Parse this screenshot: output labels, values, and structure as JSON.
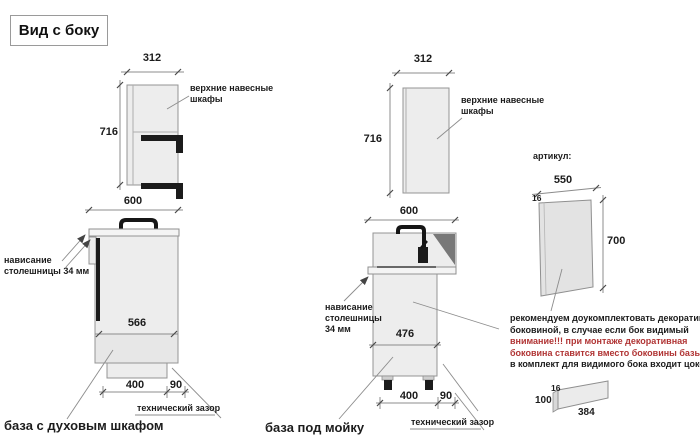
{
  "title": "Вид с боку",
  "colors": {
    "warning_red": "#b03434",
    "cabinet_fill": "#ededed",
    "line_gray": "#8c8c8c",
    "black": "#1b1b1b"
  },
  "wall_cabinet_left": {
    "width_dim": "312",
    "height_dim": "716",
    "label_line1": "верхние навесные",
    "label_line2": "шкафы"
  },
  "base_oven": {
    "width_dim": "600",
    "overhang_line1": "нависание",
    "overhang_line2": "столешницы 34 мм",
    "depth_dim": "566",
    "plinth_dim": "400",
    "gap_dim": "90",
    "gap_label": "технический зазор",
    "caption": "база с духовым шкафом"
  },
  "wall_cabinet_mid": {
    "width_dim": "312",
    "height_dim": "716",
    "label_line1": "верхние навесные",
    "label_line2": "шкафы"
  },
  "base_sink": {
    "width_dim": "600",
    "overhang_line1": "нависание",
    "overhang_line2": "столешницы",
    "overhang_line3": "34 мм",
    "depth_dim": "476",
    "plinth_dim": "400",
    "gap_dim": "90",
    "gap_label": "технический зазор",
    "caption": "база под мойку"
  },
  "decor_panel": {
    "header": "артикул:",
    "width_dim": "550",
    "thickness_dim": "16",
    "height_dim": "700"
  },
  "note": {
    "line1": "рекомендуем доукомплектовать декоративной",
    "line2": "боковиной, в случае если бок видимый",
    "line3": "внимание!!! при монтаже декоративная",
    "line4": "боковина ставится вместо боковины базы лдсп",
    "line5": "в комплект для видимого бока входит цоколь:"
  },
  "plinth": {
    "thickness_dim": "16",
    "height_dim": "100",
    "length_dim": "384"
  }
}
